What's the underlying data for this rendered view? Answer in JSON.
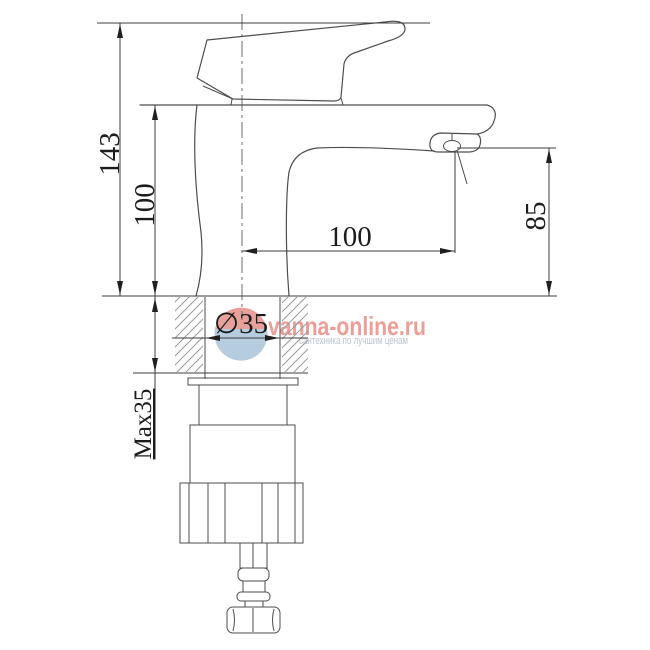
{
  "dimensions": {
    "total_height": "143",
    "upper_body_height": "100",
    "spout_reach": "100",
    "outlet_height": "85",
    "mounting_hole_diameter": "∅35",
    "max_mounting_thickness": "Max35"
  },
  "watermark": {
    "site": "vanna-online.ru",
    "tagline": "сантехника по лучшим ценам",
    "brand_color": "#ec8d85",
    "tagline_color": "#b6c0cb",
    "logo_icon": "water-drop-logo",
    "logo_top_color": "#e28a82",
    "logo_bottom_color": "#a4c1d8"
  },
  "drawing": {
    "line_color": "#4d4d4d",
    "hatch_color": "#9a9a9a",
    "background": "#ffffff"
  }
}
